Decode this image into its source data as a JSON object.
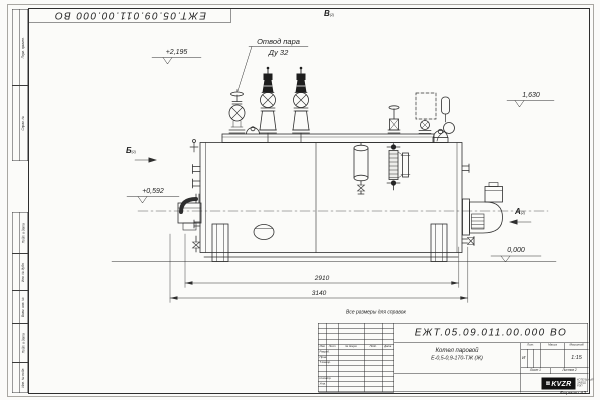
{
  "sheet": {
    "doc_number": "ЕЖТ.05.09.011.00.000  ВО",
    "doc_number_top": "ЕЖТ.05.09.011.00.000  ВО",
    "reference_note": "Все размеры для справок",
    "format_label": "Формат А3"
  },
  "title_block": {
    "product_title_line1": "Котел паровой",
    "product_title_line2": "Е-0,5-0,9-170-ТЖ (Ж)",
    "header_cols": [
      "Изм.",
      "Лист",
      "№ докум.",
      "Подп.",
      "Дата"
    ],
    "roles": [
      "Разраб.",
      "Пров.",
      "Т.контр.",
      "Н.контр.",
      "Утв."
    ],
    "prop_headers": [
      "Лит.",
      "Масса",
      "Масштаб"
    ],
    "liter_value": "И",
    "scale_value": "1:15",
    "sheet_no": "Лист 1",
    "sheets_total": "Листов 2",
    "company_logo_mark": "▦",
    "company_logo_text": "KVZR",
    "company_name_line1": "КОТЕЛЬНЫЙ",
    "company_name_line2": "ЗАВОД РЭП"
  },
  "margin": {
    "labels": [
      "Перв. примен.",
      "Справ. №",
      "Подп. и дата",
      "Инв. № дубл.",
      "Взам. инв. №",
      "Подп. и дата",
      "Инв. № подл."
    ]
  },
  "annotations": {
    "steam_outlet_line1": "Отвод пара",
    "steam_outlet_line2": "Ду 32",
    "view_top": "В",
    "view_left": "Б",
    "view_right": "А",
    "view_sheet_ref": "(2)",
    "elev_platform": "+2,195",
    "elev_gauge": "1,630",
    "elev_pump": "+0,592",
    "elev_ground": "0,000",
    "dim_shell_length": "2910",
    "dim_overall_length": "3140"
  }
}
